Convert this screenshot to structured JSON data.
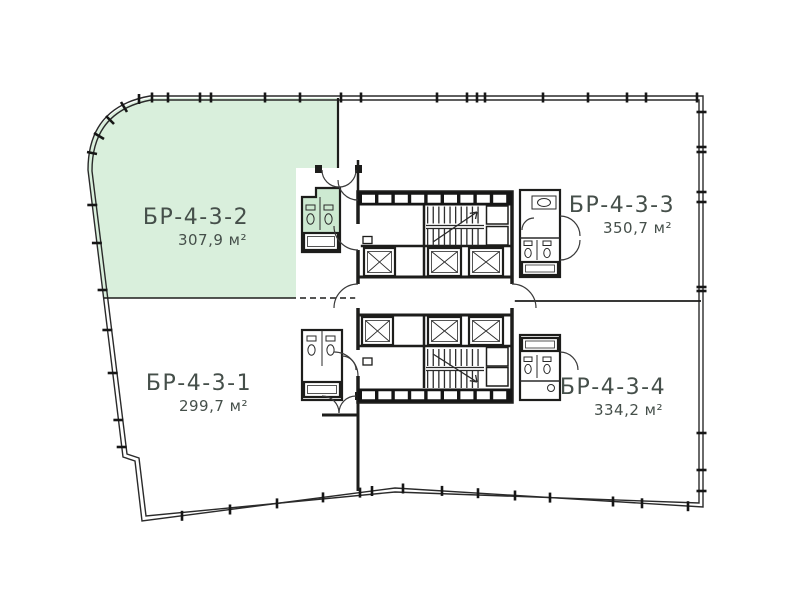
{
  "plan": {
    "title": "Floor plan — building section БР-4-3",
    "units": [
      {
        "id": "БР-4-3-1",
        "area": "299,7 м²",
        "highlighted": false
      },
      {
        "id": "БР-4-3-2",
        "area": "307,9 м²",
        "highlighted": true
      },
      {
        "id": "БР-4-3-3",
        "area": "350,7 м²",
        "highlighted": false
      },
      {
        "id": "БР-4-3-4",
        "area": "334,2 м²",
        "highlighted": false
      }
    ],
    "colors": {
      "highlight": "#d9efdc",
      "highlight_dark": "#cde9d1",
      "wall": "#1d1d1b",
      "label": "#454f4a",
      "background": "#ffffff"
    }
  }
}
